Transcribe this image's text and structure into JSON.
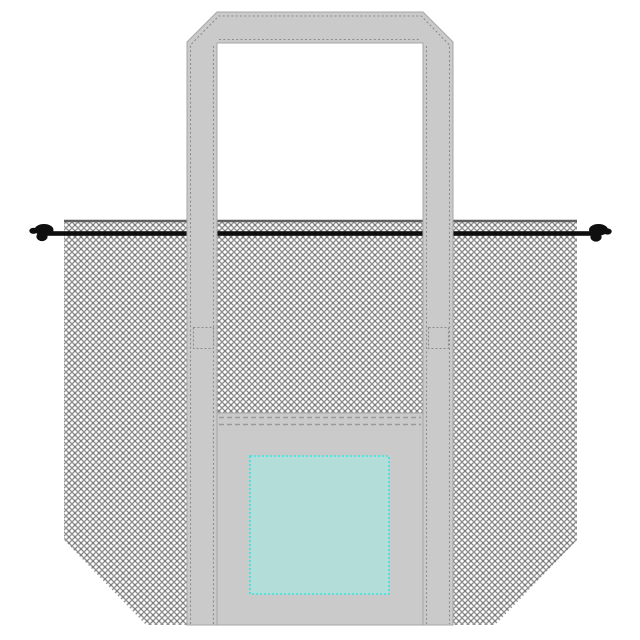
{
  "drawing": {
    "subject": "mesh-drawstring-tote-bag-template",
    "parts": {
      "mesh_body": "diamond-mesh fabric body with beveled bottom corners",
      "mesh_hem": "reinforced top hem edge of mesh",
      "drawstring": "black drawstring cord through top casing",
      "drawstring_knot_left": "knot at left cord end",
      "drawstring_knot_right": "knot at right cord end",
      "handle": "continuous webbing handle strap (two verticals + top bar, beveled corners)",
      "handle_stitching": "dotted stitch lines inset along strap edges",
      "strap_tab_left": "stitched reinforcement tab on left strap",
      "strap_tab_right": "stitched reinforcement tab on right strap",
      "bottom_panel": "solid fabric bottom panel between straps",
      "panel_stitching": "double dashed seam at panel top",
      "pocket": "teal imprint/pocket area with dashed border"
    }
  },
  "colors": {
    "background": "#ffffff",
    "strap_fill": "#cacaca",
    "strap_edge": "#a6a6a6",
    "stitch": "#8c8c8c",
    "panel_fill": "#cacaca",
    "panel_edge": "#a6a6a6",
    "panel_seam": "#999999",
    "mesh_line": "#8f8f8f",
    "mesh_node": "#707070",
    "mesh_bg": "#ffffff",
    "mesh_hem": "#5f5f5f",
    "cord": "#0f0f0f",
    "tab_fill": "#cacaca",
    "pocket_fill": "#b2ddd8",
    "pocket_border": "#35e6e0"
  }
}
